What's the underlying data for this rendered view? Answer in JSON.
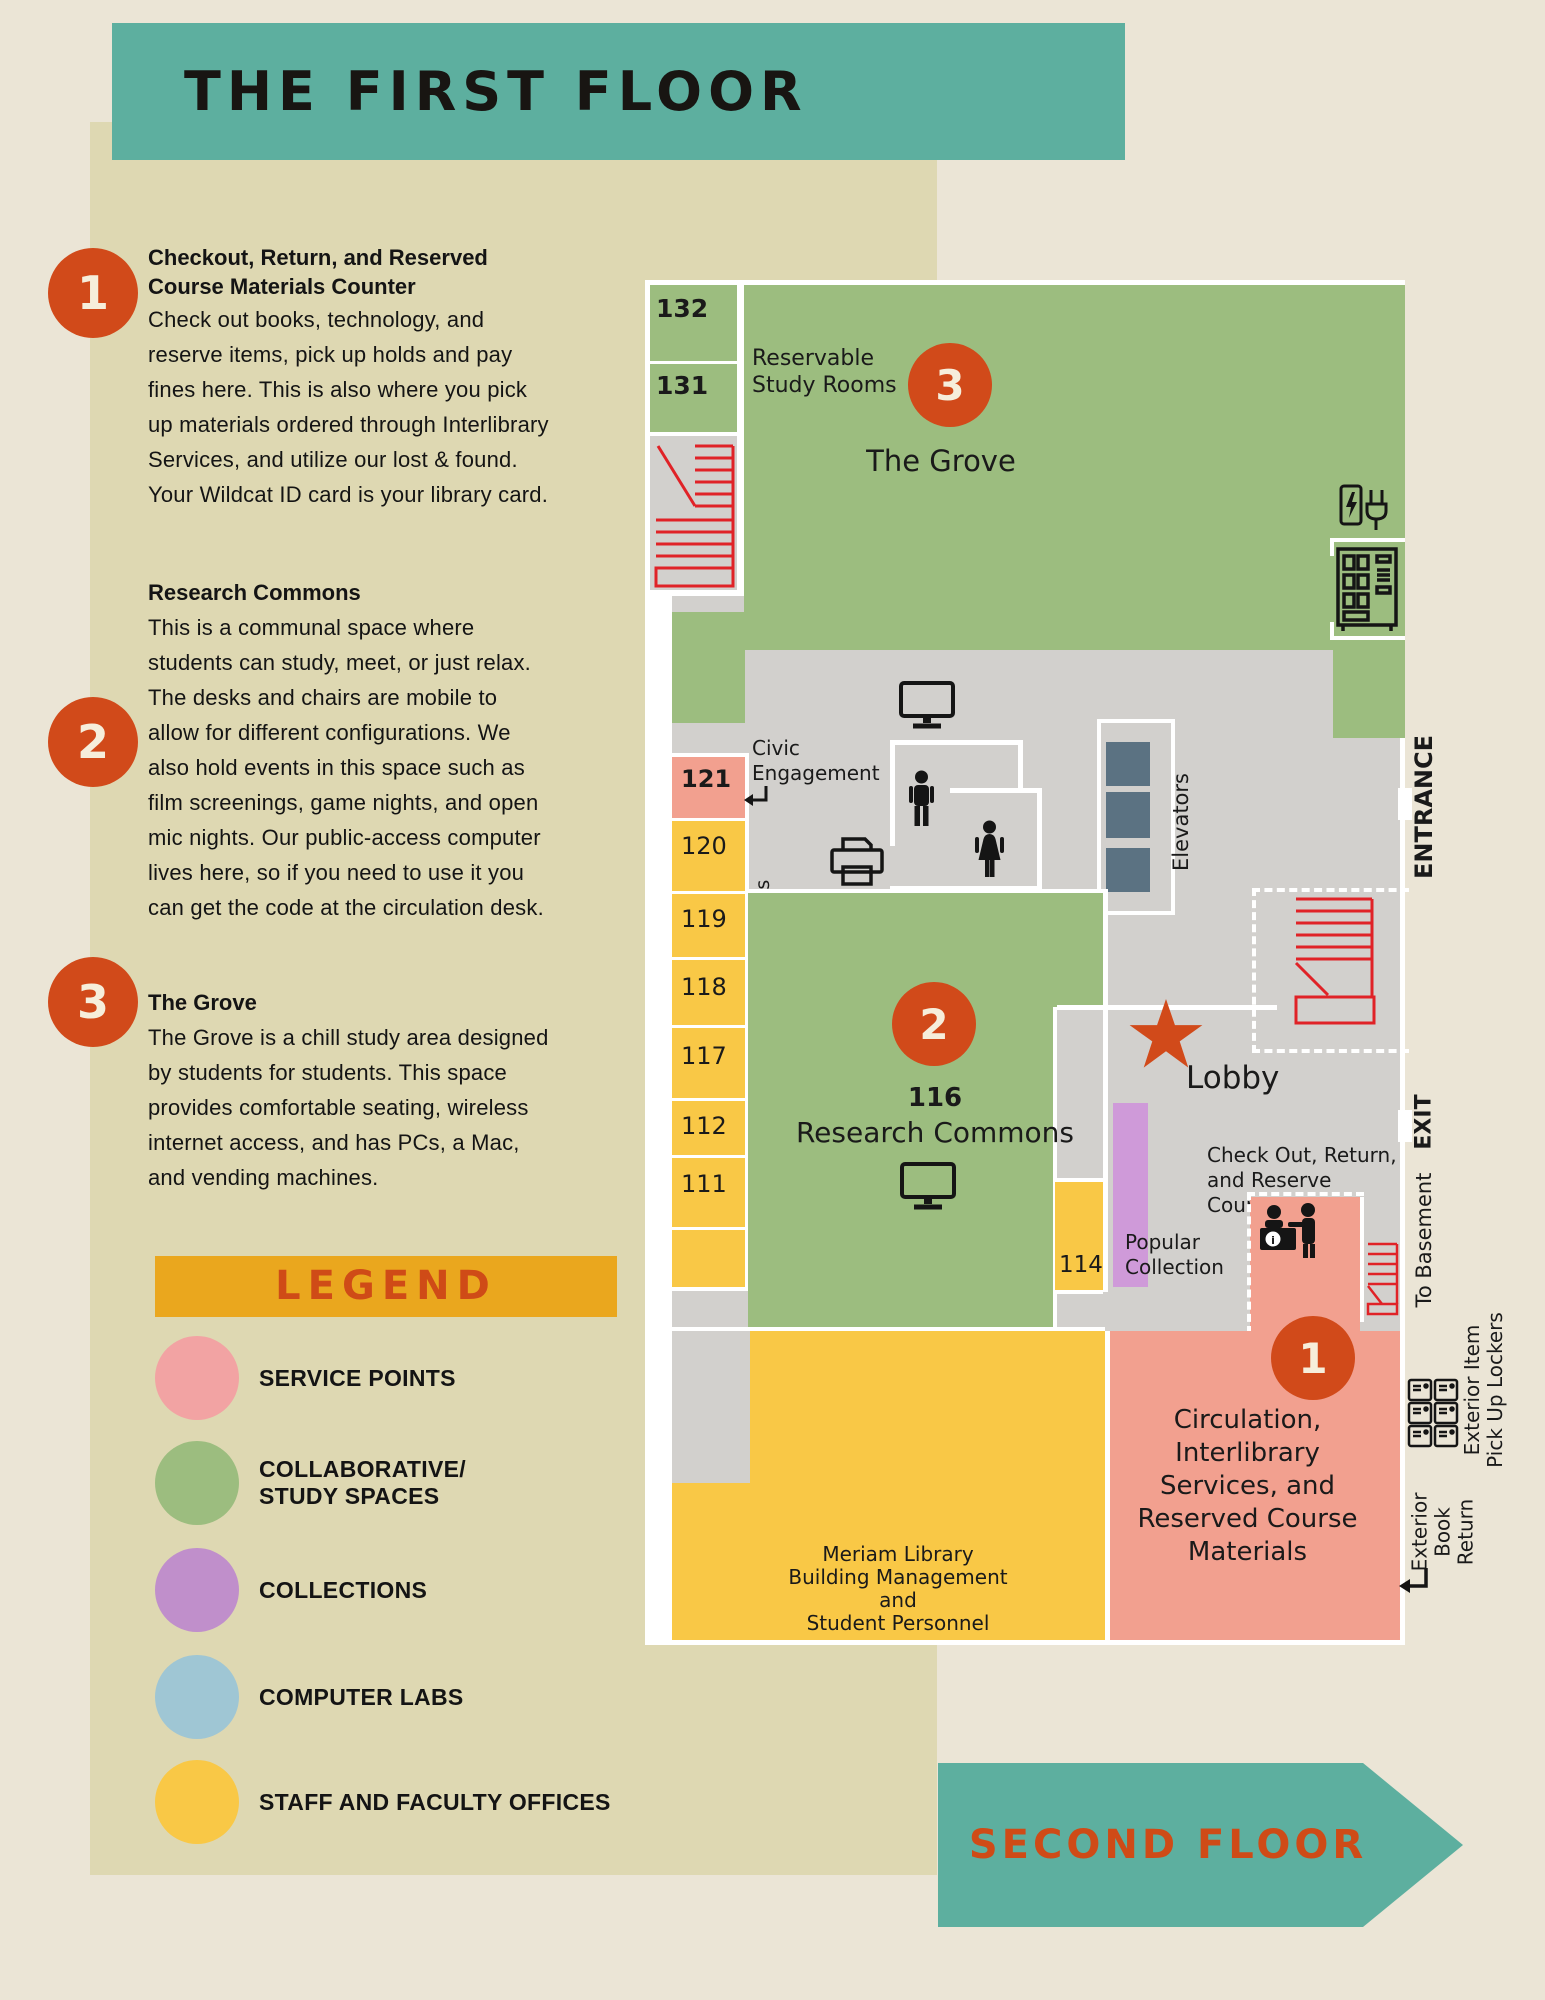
{
  "title": "THE FIRST FLOOR",
  "notes": [
    {
      "num": "1",
      "heading": "Checkout, Return, and Reserved Course Materials Counter",
      "body": "Check out books, technology, and reserve items, pick up holds and pay fines here. This is also where you pick up materials ordered through Interlibrary Services, and utilize our lost & found. Your Wildcat ID card is your library card."
    },
    {
      "num": "2",
      "heading": "Research Commons",
      "body": "This is a communal space where students can study, meet, or just relax. The desks and chairs are mobile to allow for different configurations. We also hold events in this space such as film screenings, game nights, and open mic nights. Our public-access computer lives here, so if you need to use it you can get the code at the circulation desk."
    },
    {
      "num": "3",
      "heading": "The Grove",
      "body": "The Grove is a chill study area designed by students for students. This space provides comfortable seating, wireless internet access, and has PCs, a Mac, and vending machines."
    }
  ],
  "legend": {
    "title": "LEGEND",
    "items": [
      {
        "label": "SERVICE POINTS",
        "color": "#f2a3a3"
      },
      {
        "label": "COLLABORATIVE/|STUDY SPACES",
        "color": "#9cbd7f"
      },
      {
        "label": "COLLECTIONS",
        "color": "#c08fcb"
      },
      {
        "label": "COMPUTER LABS",
        "color": "#9fc6d4"
      },
      {
        "label": "STAFF AND FACULTY OFFICES",
        "color": "#f9c846"
      }
    ]
  },
  "map": {
    "room_numbers": {
      "r132": "132",
      "r131": "131",
      "r121": "121",
      "r120": "120",
      "r119": "119",
      "r118": "118",
      "r117": "117",
      "r112": "112",
      "r111": "111",
      "r116": "116",
      "r114": "114"
    },
    "labels": {
      "reservable": "Reservable|Study Rooms",
      "grove": "The Grove",
      "civic": "Civic|Engagement",
      "elevators": "Elevators",
      "entrance": "ENTRANCE",
      "exit": "EXIT",
      "lobby": "Lobby",
      "checkout": "Check Out, Return,|and Reserve Counter",
      "popular": "Popular|Collection",
      "to_basement": "To Basement",
      "research": "Research Commons",
      "staff_offices": "Meriam Library Staff and Faculty Offices",
      "building_mgmt": "Meriam Library|Building Management and|Student Personnel",
      "circulation": "Circulation,|Interlibrary|Services, and|Reserved Course|Materials",
      "lockers": "Exterior Item|Pick Up Lockers",
      "book_return": "Exterior|Book|Return"
    },
    "badges": {
      "b1": "1",
      "b2": "2",
      "b3": "3"
    },
    "icons": [
      "stairs-icon",
      "computer-icon",
      "printer-icon",
      "man-icon",
      "woman-icon",
      "elevator-shaft",
      "charging-station-icon",
      "vending-machine-icon",
      "service-desk-icon",
      "lockers-icon",
      "star-icon",
      "return-arrow-icon"
    ]
  },
  "footer": {
    "next": "SECOND FLOOR"
  },
  "colors": {
    "banner_teal": "#5daf9f",
    "accent_orange": "#d14a1a",
    "legend_bar_gold": "#eaa71e",
    "panel_beige": "#ded8b2",
    "page_cream": "#ebe5d6",
    "corridor_gray": "#d2d0cd",
    "stair_red": "#e02227",
    "elevator_slate": "#5b7282",
    "map_green": "#9cbd7f",
    "map_yellow": "#f9c846",
    "map_pink": "#f2a08f",
    "collection_purple": "#cf9ad9"
  }
}
